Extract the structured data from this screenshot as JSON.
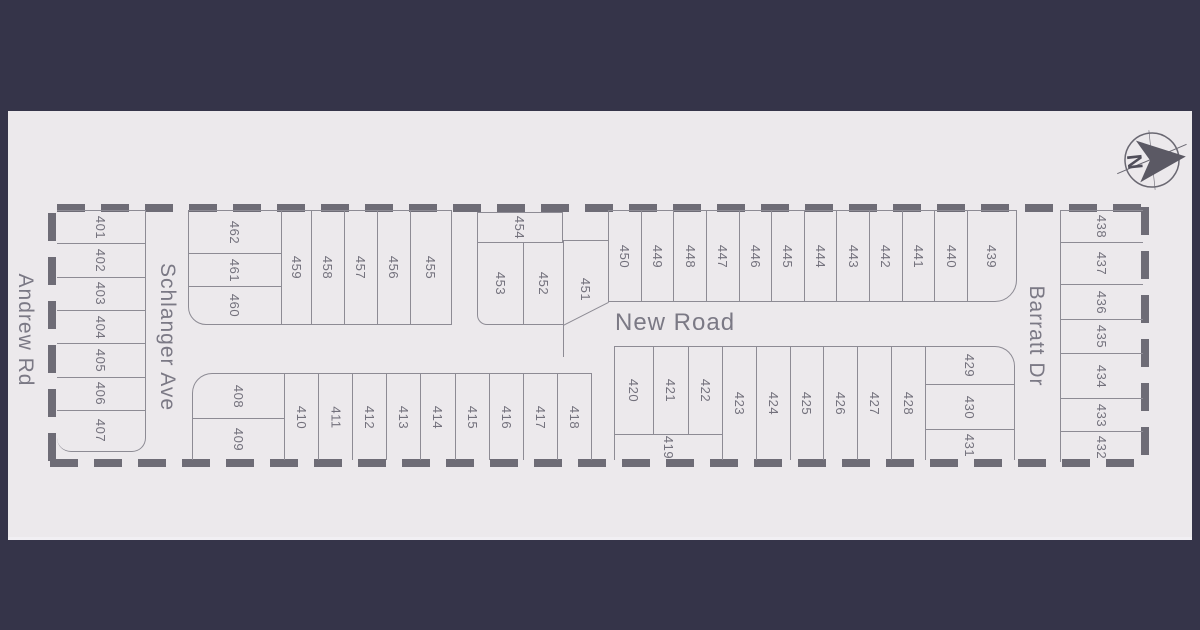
{
  "map": {
    "streets": {
      "andrew_rd": "Andrew Rd",
      "schlanger_ave": "Schlanger Ave",
      "new_road": "New Road",
      "barratt_dr": "Barratt Dr"
    },
    "compass": {
      "north": "N"
    },
    "lots": {
      "l401": "401",
      "l402": "402",
      "l403": "403",
      "l404": "404",
      "l405": "405",
      "l406": "406",
      "l407": "407",
      "l408": "408",
      "l409": "409",
      "l410": "410",
      "l411": "411",
      "l412": "412",
      "l413": "413",
      "l414": "414",
      "l415": "415",
      "l416": "416",
      "l417": "417",
      "l418": "418",
      "l419": "419",
      "l420": "420",
      "l421": "421",
      "l422": "422",
      "l423": "423",
      "l424": "424",
      "l425": "425",
      "l426": "426",
      "l427": "427",
      "l428": "428",
      "l429": "429",
      "l430": "430",
      "l431": "431",
      "l432": "432",
      "l433": "433",
      "l434": "434",
      "l435": "435",
      "l436": "436",
      "l437": "437",
      "l438": "438",
      "l439": "439",
      "l440": "440",
      "l441": "441",
      "l442": "442",
      "l443": "443",
      "l444": "444",
      "l445": "445",
      "l446": "446",
      "l447": "447",
      "l448": "448",
      "l449": "449",
      "l450": "450",
      "l451": "451",
      "l452": "452",
      "l453": "453",
      "l454": "454",
      "l455": "455",
      "l456": "456",
      "l457": "457",
      "l458": "458",
      "l459": "459",
      "l460": "460",
      "l461": "461",
      "l462": "462"
    }
  },
  "colors": {
    "background": "#353449",
    "map_background": "#ece9ec",
    "parcel_line": "#8d8b94",
    "boundary_dash": "#6e6c76",
    "lot_text": "#73717c",
    "street_text": "#7b7985"
  }
}
